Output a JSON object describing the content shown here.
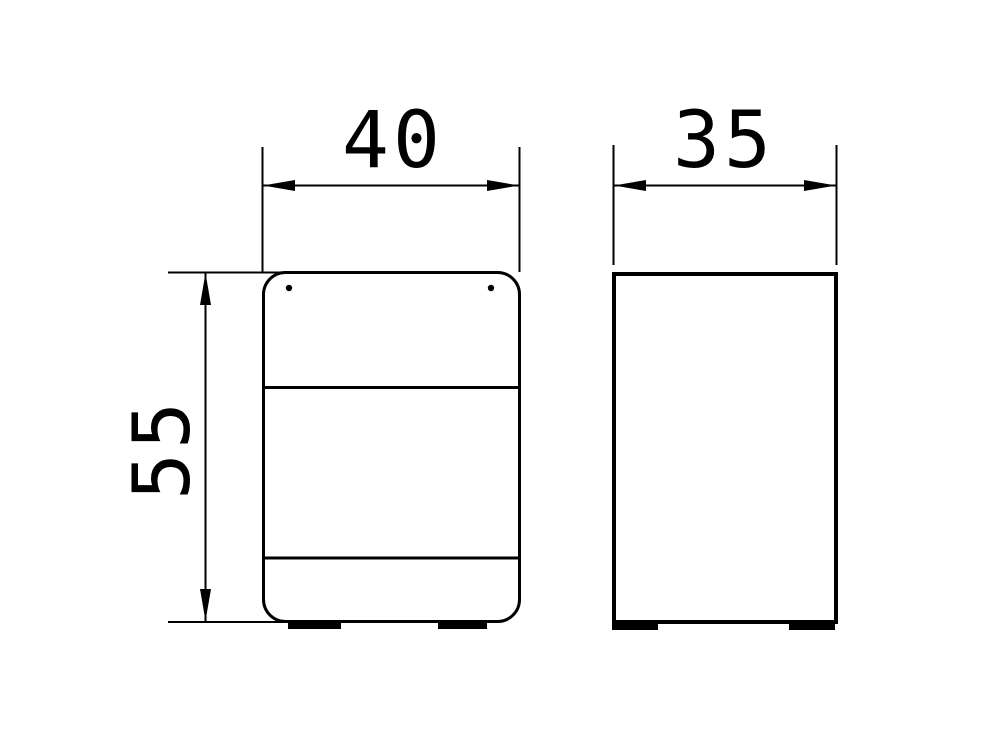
{
  "drawing": {
    "background_color": "#ffffff",
    "line_color": "#000000",
    "dimensions": {
      "width": {
        "label": "40"
      },
      "depth": {
        "label": "35"
      },
      "height": {
        "label": "55"
      }
    }
  }
}
